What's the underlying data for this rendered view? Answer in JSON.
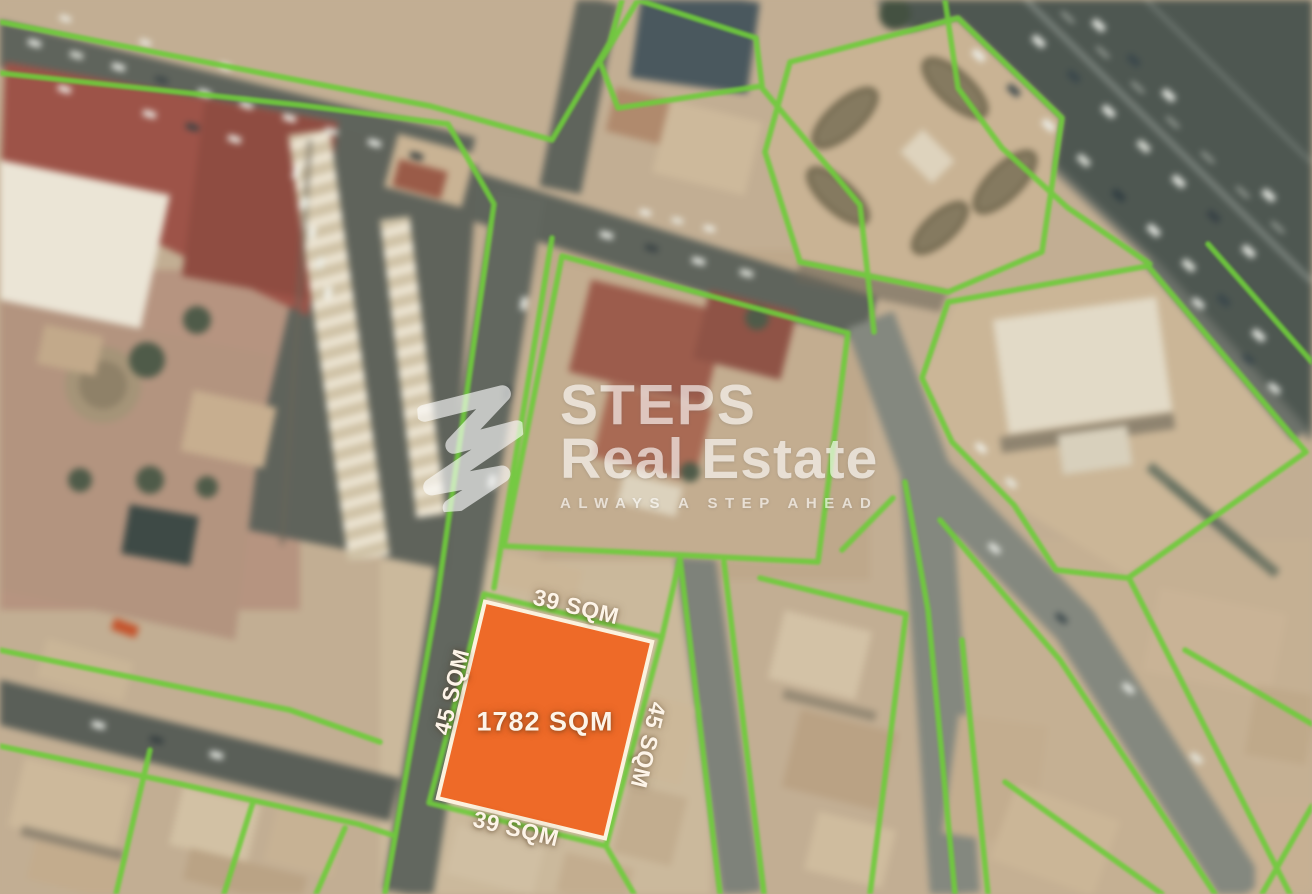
{
  "map": {
    "description": "blurred satellite aerial view with green parcel boundary lines",
    "boundary_color": "#6FCB3C",
    "plot": {
      "area_label": "1782 SQM",
      "side_top_label": "39 SQM",
      "side_left_label": "45 SQM",
      "side_right_label": "45 SQM",
      "side_bottom_label": "39 SQM",
      "fill_color": "#EE6A28",
      "border_color": "#FBF2DE",
      "label_color": "#FDF4E8"
    }
  },
  "watermark": {
    "brand_line1": "STEPS",
    "brand_line2": "Real Estate",
    "tagline": "ALWAYS A STEP AHEAD",
    "logo_icon": "steps-zigzag-logo",
    "text_color": "#FFFFFF"
  }
}
